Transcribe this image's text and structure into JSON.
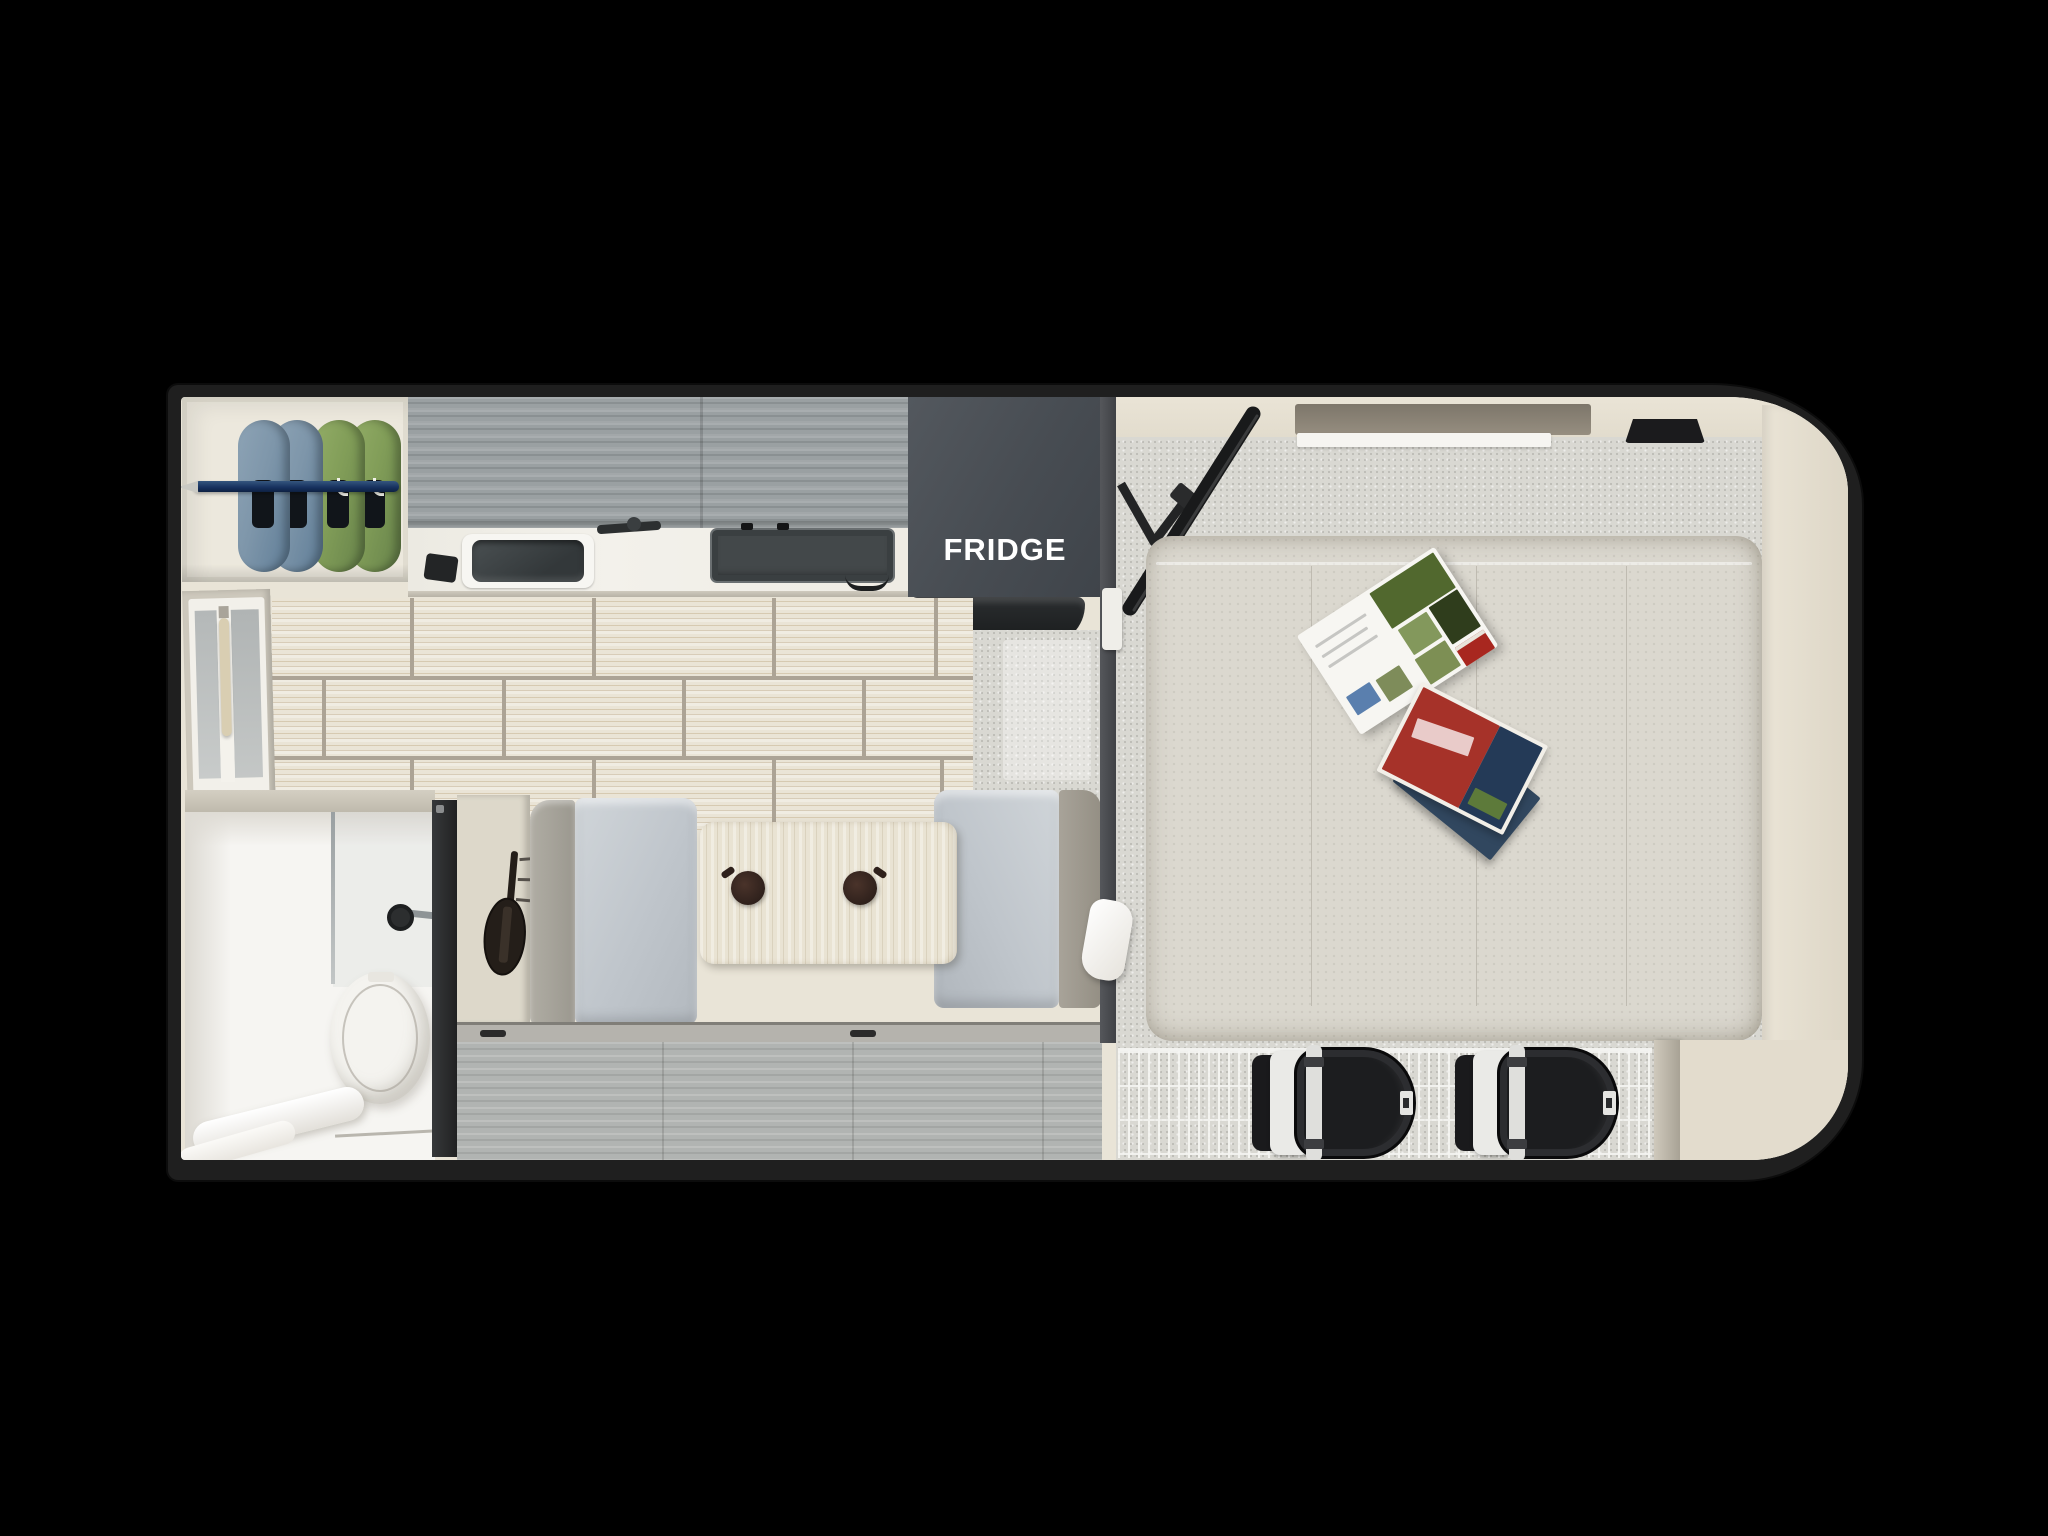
{
  "scene": {
    "type": "rv-truck-camper-floorplan-top-view",
    "labels": {
      "fridge": "FRIDGE"
    },
    "rooms_visible": [
      "closet",
      "kitchen",
      "bathroom",
      "dinette",
      "bedroom"
    ],
    "colors": {
      "background": "#000000",
      "shell_border": "#1f1f1f",
      "interior_cream": "#e9e4d7",
      "cabinet_gray_wood": "#9aa0a2",
      "counter_white": "#f1efe9",
      "fridge_gray": "#474c52",
      "fridge_text": "#ffffff",
      "floor_tile": "#eae4d6",
      "tile_grout": "#aca395",
      "carpet_gray": "#d9d8d2",
      "bed_linen": "#dbd8cf",
      "dinette_cushion": "#c4cad0",
      "dinette_backrest": "#a19c90",
      "table_wood": "#e9e3d3",
      "entry_floor_wood": "#b1b4b2",
      "jacket_blue": "#7e96aa",
      "jacket_green": "#819d58",
      "closet_rod_navy": "#1e3a6e",
      "bathroom_white": "#f6f5f2",
      "door_dark": "#2e2f30",
      "tv_black": "#1a1b1c",
      "backpack_black": "#1c1d1f",
      "wire_rack_white": "#f6f6f3",
      "magazine_red": "#a63229",
      "magazine_green": "#51682e"
    }
  }
}
